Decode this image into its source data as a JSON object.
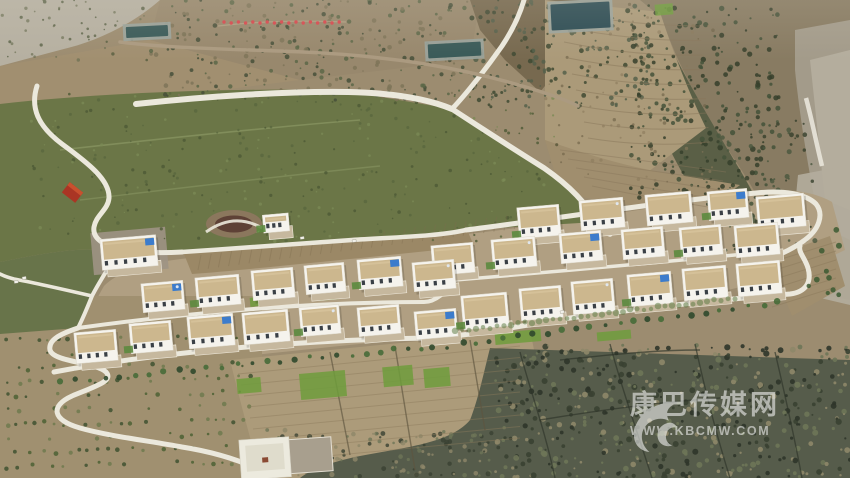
{
  "watermark": {
    "site_name": "康巴传媒网",
    "url": "WWW.KBCMW.COM",
    "logo_icon": "kbcmw-bird-swoosh",
    "opacity": 0.55
  },
  "palette": {
    "base_slope": "#9c8c70",
    "scree": "#b6b0a1",
    "dark_ridge": "#77694f",
    "mountain": "#887b62",
    "mountain_veg": "#4a543c",
    "canyon": "#a39b8a",
    "canyon_light": "#b4ad9d",
    "white_streak": "#e9e6da",
    "green_field": "#6b7647",
    "green_field_edge": "#68744a",
    "village_ground": "#b09f82",
    "plowed_strip": "#9b8866",
    "terraced_field": "#ab9a79",
    "terraced_field2": "#a08e6e",
    "bottom_left": "#a09070",
    "bottom_mid": "#ac9b7a",
    "bottom_dark": "#565c4b",
    "road": "#ebe8dc",
    "dirt_road": "#ab9a80",
    "house_wall": "#f5f3ed",
    "house_roof": "#ccb78e",
    "house_window": "#3a4046",
    "courtyard": "#c6b89e",
    "tarp_blue": "#3c7ccc",
    "grass_green": "#5c8a3e",
    "flag_red": "#d6494e",
    "pond_dark": "#2e4d54",
    "pond_dark2": "#3a5a58",
    "pond_rim": "#9aa39b",
    "red_roof": "#aa3524",
    "watermark_white": "#ffffff"
  },
  "scene": {
    "flags": {
      "count": 17
    },
    "ponds": [
      {
        "x": 551,
        "y": 3,
        "w": 59,
        "h": 26,
        "color_key": "pond_dark"
      },
      {
        "x": 428,
        "y": 43,
        "w": 53,
        "h": 14,
        "color_key": "pond_dark2"
      },
      {
        "x": 126,
        "y": 26,
        "w": 42,
        "h": 11,
        "color_key": "pond_dark2"
      }
    ],
    "red_building": {
      "x": 64,
      "y": 186,
      "w": 17,
      "h": 13
    },
    "green_patches": [
      [
        300,
        372,
        46,
        26
      ],
      [
        383,
        366,
        30,
        20
      ],
      [
        424,
        368,
        26,
        19
      ],
      [
        237,
        378,
        24,
        15
      ],
      [
        495,
        331,
        46,
        12
      ],
      [
        597,
        331,
        34,
        9
      ],
      [
        655,
        4,
        18,
        11
      ],
      [
        250,
        297,
        20,
        9
      ],
      [
        320,
        292,
        18,
        8
      ]
    ],
    "vehicles": [
      [
        300,
        237
      ],
      [
        352,
        240
      ],
      [
        14,
        281
      ],
      [
        22,
        277
      ],
      [
        560,
        311
      ]
    ],
    "village": {
      "rows": [
        {
          "name": "school",
          "houses": [
            [
              101,
              237,
              56,
              31
            ]
          ]
        },
        {
          "name": "row-1",
          "houses": [
            [
              518,
              206,
              42,
              31
            ],
            [
              580,
              199,
              44,
              30
            ],
            [
              646,
              193,
              46,
              31
            ],
            [
              708,
              190,
              40,
              29
            ],
            [
              757,
              195,
              48,
              33
            ]
          ]
        },
        {
          "name": "row-2",
          "houses": [
            [
              432,
              244,
              42,
              30
            ],
            [
              492,
              238,
              44,
              30
            ],
            [
              560,
              232,
              42,
              30
            ],
            [
              622,
              228,
              42,
              30
            ],
            [
              680,
              226,
              42,
              30
            ],
            [
              735,
              224,
              44,
              32
            ]
          ]
        },
        {
          "name": "row-3",
          "houses": [
            [
              142,
              282,
              42,
              29
            ],
            [
              196,
              276,
              44,
              30
            ],
            [
              252,
              269,
              42,
              30
            ],
            [
              305,
              264,
              40,
              29
            ],
            [
              358,
              258,
              44,
              30
            ],
            [
              413,
              261,
              42,
              29
            ]
          ]
        },
        {
          "name": "row-4",
          "houses": [
            [
              75,
              331,
              42,
              31
            ],
            [
              130,
              322,
              42,
              30
            ],
            [
              188,
              315,
              46,
              32
            ],
            [
              243,
              311,
              46,
              32
            ],
            [
              300,
              306,
              40,
              29
            ],
            [
              358,
              306,
              42,
              29
            ],
            [
              415,
              310,
              42,
              28
            ],
            [
              462,
              294,
              46,
              34
            ],
            [
              520,
              287,
              42,
              32
            ],
            [
              572,
              280,
              42,
              33
            ],
            [
              628,
              273,
              44,
              32
            ],
            [
              683,
              267,
              44,
              32
            ],
            [
              737,
              262,
              44,
              33
            ]
          ]
        },
        {
          "name": "plaza-house",
          "houses": [
            [
              263,
              214,
              26,
              18
            ]
          ]
        }
      ]
    }
  }
}
